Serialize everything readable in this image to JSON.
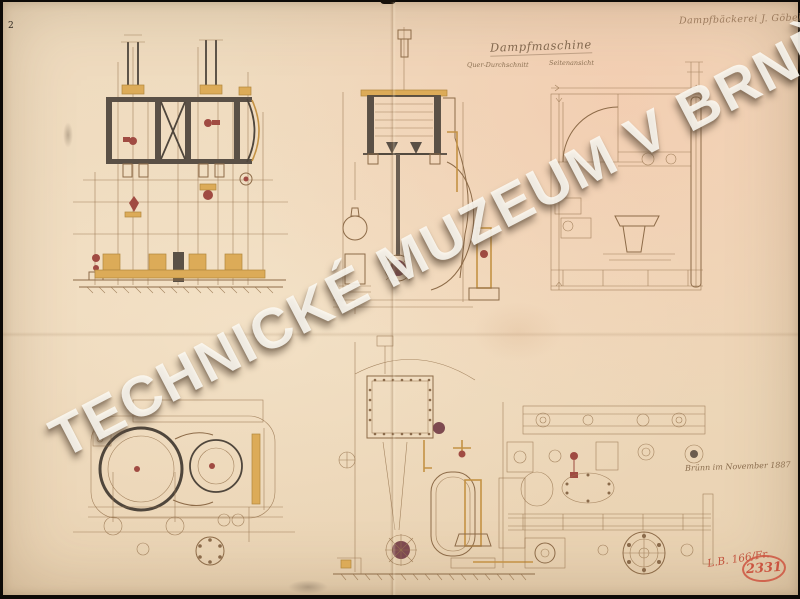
{
  "document": {
    "corner_mark": "2",
    "header_note": "Dampfbäckerei J. Göbel",
    "title": "Dampfmaschine",
    "view_labels": {
      "left": "Quer-Durchschnitt",
      "right": "Seitenansicht"
    },
    "date_note": "Brünn im November 1887",
    "inventory_note": "L.B. 166/Fr.",
    "stamp_number": "2331",
    "watermark": "TECHNICKÉ MUZEUM V BRNĚ"
  },
  "colors": {
    "paper": "#eed8ba",
    "paper_pink_tint": "#f4c8a8",
    "ink_fine": "#97744f",
    "ink_dark": "#4f463c",
    "accent_ochre": "#dcab58",
    "accent_red": "#a04b42",
    "hub_maroon": "#7e4a50",
    "stamp_red": "#ce543f",
    "watermark_white": "#fcf9f2"
  }
}
